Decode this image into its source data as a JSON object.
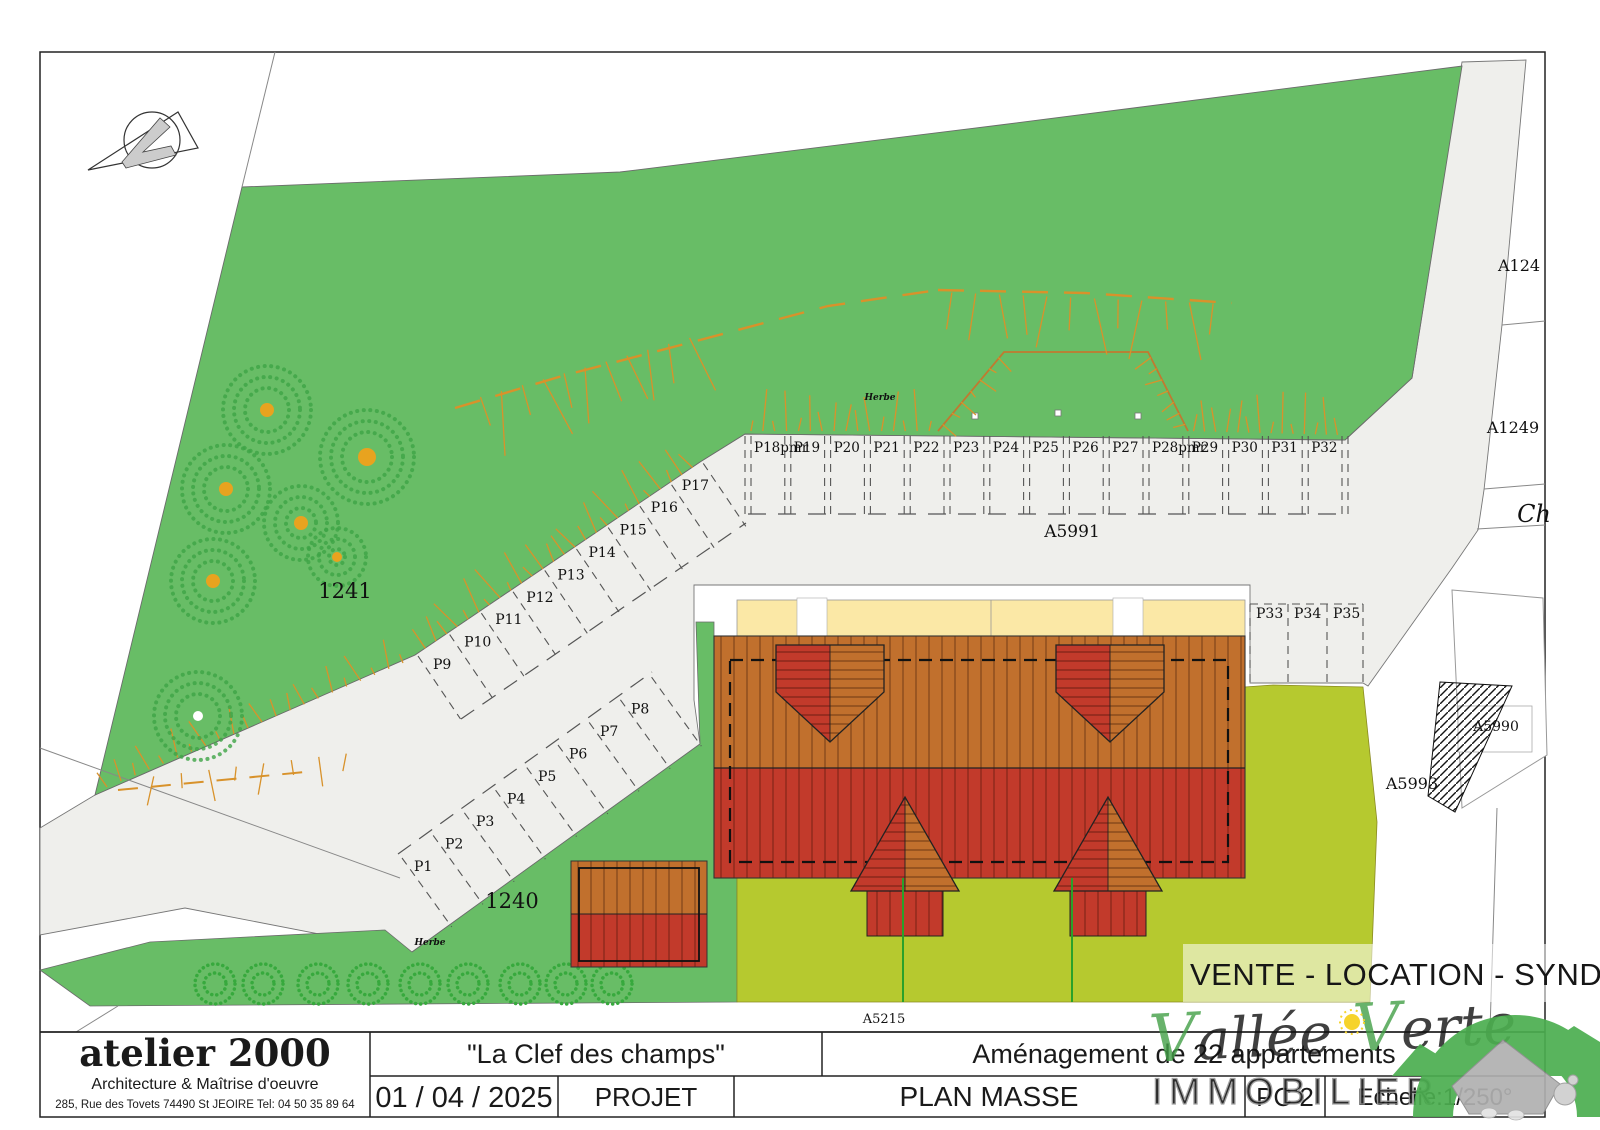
{
  "title_block": {
    "firm": {
      "name": "atelier 2000",
      "subtitle": "Architecture & Maîtrise d'oeuvre",
      "address": "285, Rue des Tovets 74490 St JEOIRE Tel: 04 50 35 89 64"
    },
    "project_name": "\"La Clef des champs\"",
    "project_desc": "Aménagement de 22 appartements",
    "date": "01 / 04 / 2025",
    "phase": "PROJET",
    "drawing_title": "PLAN MASSE",
    "sheet": "PC 2",
    "scale": "Echelle:1/250°"
  },
  "watermark": {
    "banner": "VENTE - LOCATION - SYNDIC",
    "brand_line1": "Vallée Verte",
    "brand_line2": "IMMOBILIER",
    "banner_color": "#4cb050",
    "brand_color": "#8d8d8d"
  },
  "map_labels": {
    "parcels": [
      {
        "text": "1241",
        "x": 345,
        "y": 598,
        "size": 21
      },
      {
        "text": "1240",
        "x": 512,
        "y": 908,
        "size": 21
      },
      {
        "text": "A5991",
        "x": 1072,
        "y": 537,
        "size": 17
      },
      {
        "text": "A5215",
        "x": 884,
        "y": 1023,
        "size": 13
      },
      {
        "text": "A124",
        "x": 1519,
        "y": 271,
        "size": 16
      },
      {
        "text": "A1249",
        "x": 1513,
        "y": 433,
        "size": 16
      },
      {
        "text": "A5993",
        "x": 1412,
        "y": 789,
        "size": 16
      },
      {
        "text": "A5990",
        "x": 1496,
        "y": 731,
        "size": 14
      }
    ],
    "road_name": {
      "text": "Ch",
      "x": 1534,
      "y": 522
    },
    "grass_notes": [
      {
        "text": "Herbe",
        "x": 880,
        "y": 400
      },
      {
        "text": "Herbe",
        "x": 430,
        "y": 945
      }
    ]
  },
  "parking": {
    "top_row": [
      "P18pmr",
      "P19",
      "P20",
      "P21",
      "P22",
      "P23",
      "P24",
      "P25",
      "P26",
      "P27",
      "P28pmr",
      "P29",
      "P30",
      "P31",
      "P32"
    ],
    "upper_diagonal": [
      "P9",
      "P10",
      "P11",
      "P12",
      "P13",
      "P14",
      "P15",
      "P16",
      "P17"
    ],
    "lower_diagonal": [
      "P1",
      "P2",
      "P3",
      "P4",
      "P5",
      "P6",
      "P7",
      "P8"
    ],
    "east_row": [
      "P33",
      "P34",
      "P35"
    ]
  },
  "colors": {
    "grass": "#68bd66",
    "lawn": "#b6c92f",
    "road": "#efefec",
    "roof_upper": "#c1702d",
    "roof_lower": "#c23a2b",
    "terrace": "#fbe8a6",
    "slope_hatch": "#d8922b",
    "tree_stroke": "#3da446",
    "trunk": "#e8a31f"
  }
}
